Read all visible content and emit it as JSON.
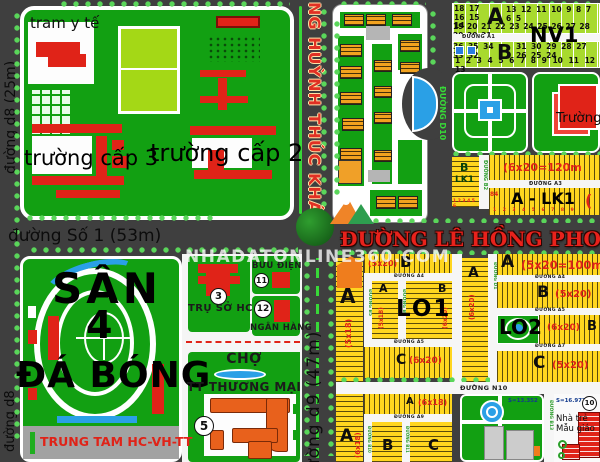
{
  "watermark": "NHADATONLINE360.COM",
  "colors": {
    "road": "#3f3f3f",
    "block_green": "#12a012",
    "lot_yellow": "#ffd61f",
    "nv1_green": "#a8da2e",
    "water_blue": "#2aa0e6",
    "building_red": "#e02318",
    "building_orange": "#f2a21f",
    "label_red": "#e8221c",
    "median_green": "#38d838"
  },
  "roads": {
    "d8_25m": "đường d8 (25m)",
    "d8": "đường d8",
    "so_1": "đường Số 1 (53m)",
    "huynh_thuc_khang": "NG HUỲNH THÚC KHÁNG",
    "le_hong_phong": "ĐƯỜNG LÊ HỒNG PHONG",
    "d9_47m": "đường d9 (47m)",
    "d10": "ĐƯỜNG D10",
    "a1": "ĐƯỜNG A1",
    "a3": "ĐƯỜNG A3",
    "a4": "ĐƯỜNG A4",
    "a5": "ĐƯỜNG A5",
    "a7": "ĐƯỜNG A7",
    "a9": "ĐƯỜNG A9",
    "n10": "ĐƯỜNG N10",
    "b2": "ĐƯỜNG B2",
    "b5": "ĐƯỜNG B5",
    "b6": "ĐƯỜNG B6",
    "b10": "ĐƯỜNG B10",
    "b11": "ĐƯỜNG B11",
    "b13": "ĐƯỜNG B13",
    "d1": "ĐƯỜNG D1"
  },
  "schools": {
    "tram_y_te": "tram y tế",
    "truong_cap_3": "trường cấp 3",
    "truong_cap_2": "trường cấp 2"
  },
  "nv1": {
    "label": "NV1",
    "block_a": {
      "letter": "A",
      "row1_left": "18 17 16 15 14",
      "row1_right": "13 12 11 10 9 8 7 6 5",
      "row2": "19 20 21 22 23 24 25 26 27 28 29 30 31"
    },
    "block_b": {
      "letter": "B",
      "row1_left": "36 35 34 33 32",
      "row1_right": "31 30 29 28 27 26 25 24",
      "row2": "1 2 3 4 5 6 7 8 9 10 11 12 13"
    }
  },
  "truong_right": "Trường",
  "lk": {
    "b": "B",
    "lk1": "LK1",
    "b_nums": "1 2 3 4 5 6",
    "size_120": "(6x20=120m",
    "a_lk1": "A - LK1",
    "paren": "(",
    "num_84": "84",
    "a_nums": "1 2 3 4 5 6 7 8 9"
  },
  "stadium": {
    "san": "SÂN",
    "four": "4",
    "da_bong": "ĐÁ BÓNG",
    "trung_tam": "TRUNG TAM HC-VH-TT"
  },
  "admin": {
    "tru_so_hc": "TRỤ SỞ HC",
    "num_3": "3",
    "buu_dien": "BƯU ĐIỆN",
    "num_11": "11",
    "ngan_hang": "NGÂN HÀNG",
    "num_12": "12",
    "cho": "CHỢ",
    "tt_thuong_mai": "TT THƯƠNG MẠI",
    "num_5": "5"
  },
  "lots": {
    "lo1": "LO1",
    "lo2": "LO2",
    "a_5x18": {
      "letter": "A",
      "size": "(5x18)"
    },
    "b_5x20_top": {
      "letter": "B",
      "size": "(5x20)"
    },
    "a_5x18_inner": {
      "letter": "A",
      "size": "(5x18)"
    },
    "b_6x20_inner": {
      "letter": "B",
      "size": "(6x20)"
    },
    "c_6x20": {
      "letter": "C",
      "size": "(6x20)"
    },
    "a_6x20": {
      "letter": "A",
      "size": "(6x20)"
    },
    "a_100": {
      "letter": "A",
      "size": "(5x20=100m"
    },
    "b_5x20_right": {
      "letter": "B",
      "size": "(5x20)"
    },
    "b_6x20_lo2": {
      "letter": "B",
      "size": "(6x20)"
    },
    "c_5x20": {
      "letter": "C",
      "size": "(5x20)"
    },
    "a_6x18_col": {
      "letter": "A",
      "size": "(6x18)"
    },
    "a_6x18_strip": {
      "letter": "A",
      "size": "(6x18)"
    },
    "b_bottom": "B",
    "c_bottom": "C"
  },
  "park": {
    "area": "S=13.352"
  },
  "kindergarten": {
    "area": "S=16.977",
    "num": "10",
    "name_line1": "Nhà trẻ",
    "name_line2": "Mẫu giáo"
  }
}
